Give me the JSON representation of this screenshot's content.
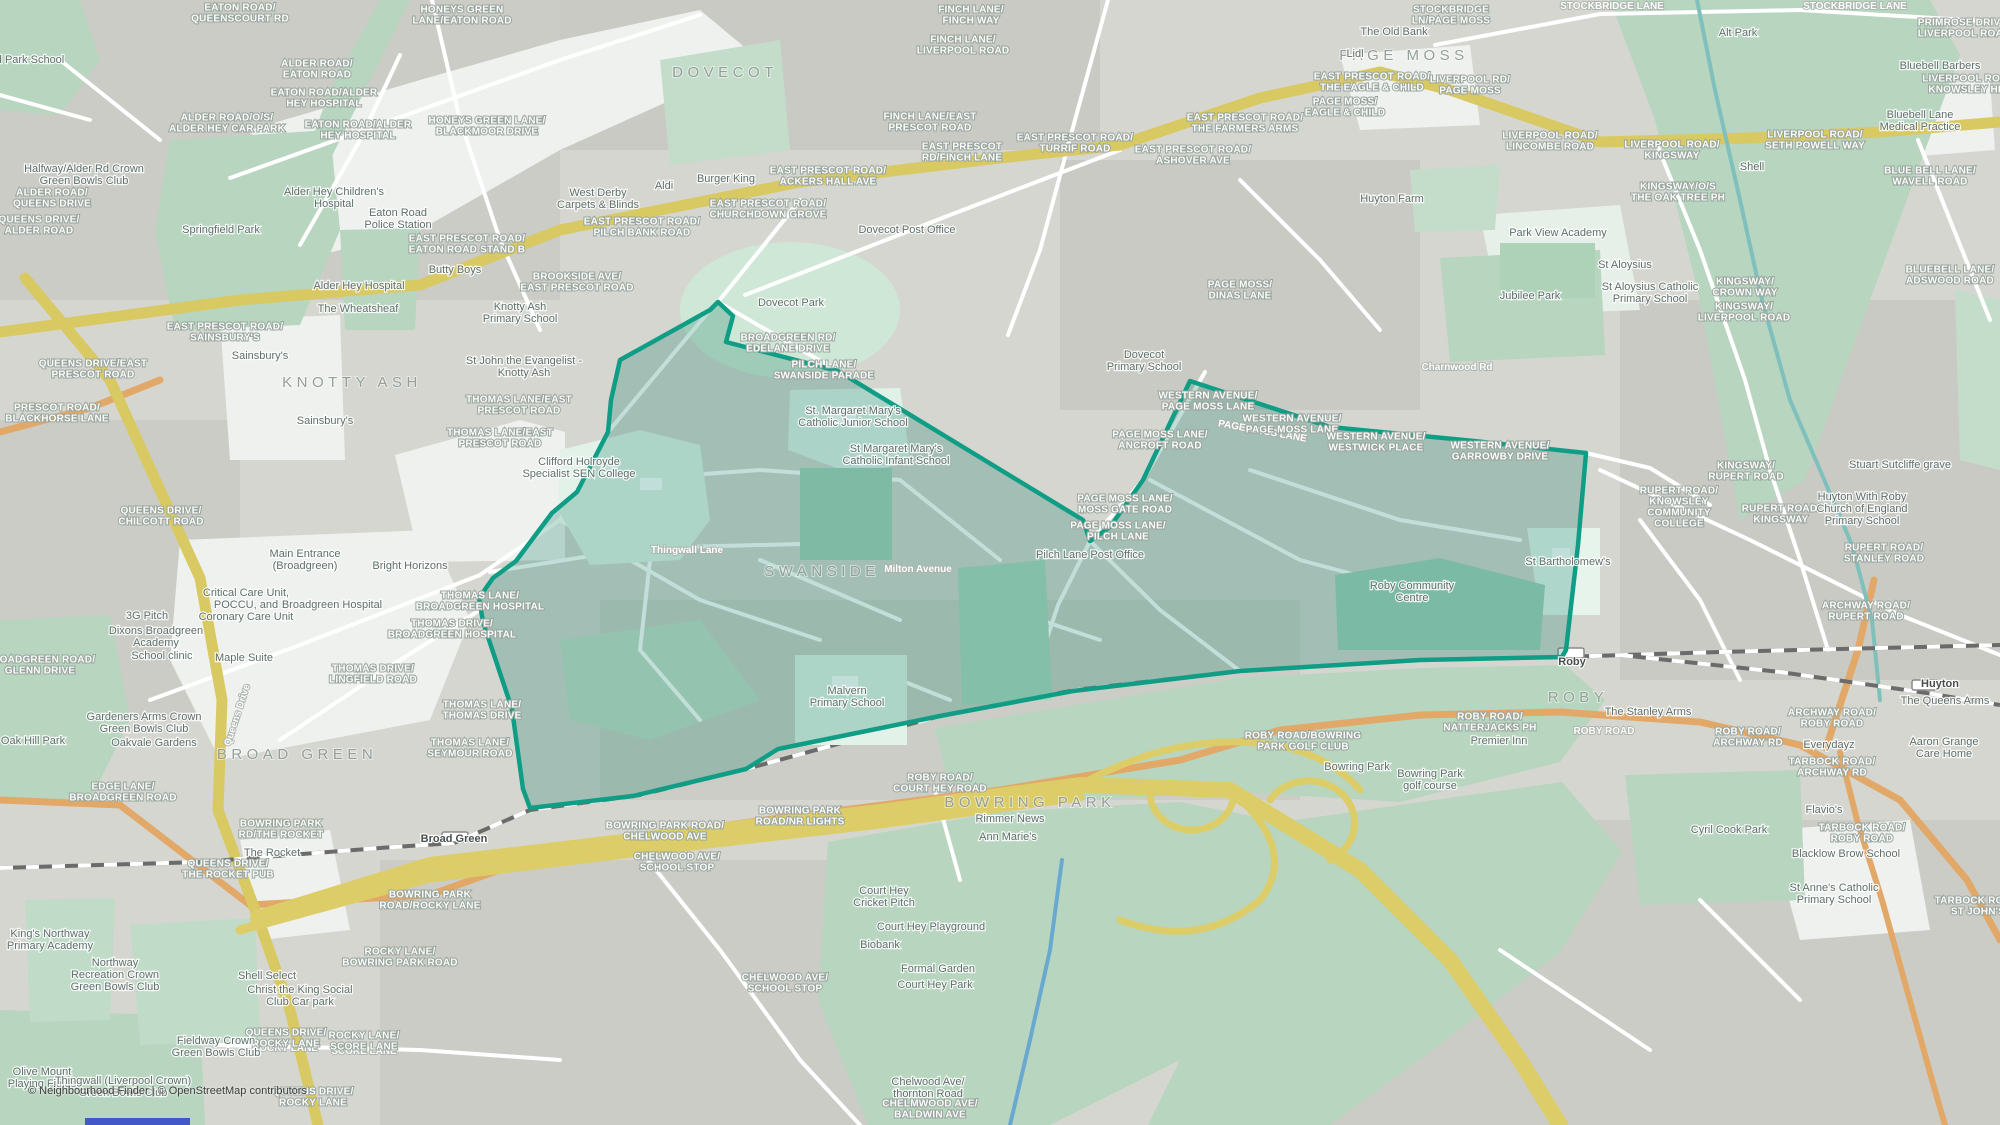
{
  "map": {
    "attribution": "© Neighbourhood Finder | © OpenStreetMap contributors",
    "colors": {
      "highlight_stroke": "#0f9e85",
      "highlight_fill": "rgba(18,128,106,0.26)",
      "motorway_yellow": "#ddcd68",
      "a_road_yellow": "#d9c963",
      "b_road_orange": "#e2a868",
      "park_green": "#b7d5bf",
      "mint": "#ddefe5",
      "water_teal": "#7fc0bd",
      "base_gray": "#d5d6d0"
    },
    "labels": {
      "districts": [
        {
          "label": "DOVECOT",
          "x": 725,
          "y": 77
        },
        {
          "label": "PAGE MOSS",
          "x": 1404,
          "y": 60
        },
        {
          "label": "KNOTTY ASH",
          "x": 352,
          "y": 387
        },
        {
          "label": "SWANSIDE",
          "x": 822,
          "y": 576
        },
        {
          "label": "BROAD GREEN",
          "x": 297,
          "y": 759
        },
        {
          "label": "BOWRING PARK",
          "x": 1030,
          "y": 807
        },
        {
          "label": "ROBY",
          "x": 1578,
          "y": 702
        }
      ],
      "stations": [
        {
          "label": "Broad Green",
          "x": 454,
          "y": 842
        },
        {
          "label": "Roby",
          "x": 1572,
          "y": 665
        },
        {
          "label": "Huyton",
          "x": 1940,
          "y": 687
        }
      ],
      "road_labels": [
        {
          "label": "Queens Drive",
          "x": 240,
          "y": 716,
          "rot": -72
        },
        {
          "label": "PAGE MOSS LANE",
          "x": 1262,
          "y": 434,
          "rot": 10
        },
        {
          "label": "ROBY ROAD",
          "x": 1604,
          "y": 734
        },
        {
          "label": "ROCKY LANE",
          "x": 285,
          "y": 1051
        },
        {
          "label": "SCORE LANE",
          "x": 364,
          "y": 1054
        },
        {
          "label": "STOCKBRIDGE LANE",
          "x": 1612,
          "y": 9
        },
        {
          "label": "STOCKBRIDGE LANE",
          "x": 1855,
          "y": 9
        },
        {
          "label": "Thingwall Lane",
          "x": 687,
          "y": 553
        },
        {
          "label": "Milton Avenue",
          "x": 918,
          "y": 572
        },
        {
          "label": "Charnwood Rd",
          "x": 1457,
          "y": 370
        }
      ],
      "bus_stops": [
        {
          "label": "EATON ROAD/\nQUEENSCOURT RD",
          "x": 240,
          "y": 16
        },
        {
          "label": "HONEYS GREEN\nLANE/EATON ROAD",
          "x": 462,
          "y": 18
        },
        {
          "label": "ALDER ROAD/\nEATON ROAD",
          "x": 317,
          "y": 72
        },
        {
          "label": "EATON ROAD/ALDER\nHEY HOSPITAL",
          "x": 324,
          "y": 101
        },
        {
          "label": "EATON ROAD/ALDER\nHEY HOSPITAL",
          "x": 358,
          "y": 133
        },
        {
          "label": "ALDER ROAD/O/S/\nALDER HEY CAR PARK",
          "x": 227,
          "y": 126
        },
        {
          "label": "HONEYS GREEN LANE/\nBLACKMOOR DRIVE",
          "x": 487,
          "y": 129
        },
        {
          "label": "ALDER ROAD/\nQUEENS DRIVE",
          "x": 52,
          "y": 201
        },
        {
          "label": "QUEENS DRIVE/\nALDER ROAD",
          "x": 39,
          "y": 228
        },
        {
          "label": "EAST PRESCOT ROAD/\nEATON ROAD STAND B",
          "x": 467,
          "y": 247
        },
        {
          "label": "EAST PRESCOT ROAD/\nSAINSBURY'S",
          "x": 225,
          "y": 335
        },
        {
          "label": "QUEENS DRIVE/EAST\nPRESCOT ROAD",
          "x": 93,
          "y": 372
        },
        {
          "label": "PRESCOT ROAD/\nBLACKHORSE LANE",
          "x": 57,
          "y": 416
        },
        {
          "label": "QUEENS DRIVE/\nCHILCOTT ROAD",
          "x": 161,
          "y": 519
        },
        {
          "label": "THOMAS LANE/EAST\nPRESCOT ROAD",
          "x": 519,
          "y": 408
        },
        {
          "label": "THOMAS LANE/EAST\nPRESCOT ROAD",
          "x": 500,
          "y": 441
        },
        {
          "label": "BROOKSIDE AVE/\nEAST PRESCOT ROAD",
          "x": 577,
          "y": 285
        },
        {
          "label": "EAST PRESCOT ROAD/\nPILCH BANK ROAD",
          "x": 642,
          "y": 230
        },
        {
          "label": "EAST PRESCOT ROAD/\nCHURCHDOWN GROVE",
          "x": 768,
          "y": 212
        },
        {
          "label": "EAST PRESCOT ROAD/\nACKERS HALL AVE",
          "x": 828,
          "y": 179
        },
        {
          "label": "FINCH LANE/EAST\nPRESCOT ROAD",
          "x": 930,
          "y": 125
        },
        {
          "label": "EAST PRESCOT\nRD/FINCH LANE",
          "x": 962,
          "y": 155
        },
        {
          "label": "FINCH LANE/\nFINCH WAY",
          "x": 971,
          "y": 18
        },
        {
          "label": "FINCH LANE/\nLIVERPOOL ROAD",
          "x": 963,
          "y": 48
        },
        {
          "label": "EAST PRESCOT ROAD/\nTURRIF ROAD",
          "x": 1075,
          "y": 146
        },
        {
          "label": "EAST PRESCOT ROAD/\nTHE EAGLE & CHILD",
          "x": 1372,
          "y": 85
        },
        {
          "label": "PAGE MOSS/\nEAGLE & CHILD",
          "x": 1345,
          "y": 110
        },
        {
          "label": "EAST PRESCOT ROAD/\nTHE FARMERS ARMS",
          "x": 1245,
          "y": 126
        },
        {
          "label": "EAST PRESCOT ROAD/\nASHOVER AVE",
          "x": 1193,
          "y": 158
        },
        {
          "label": "LIVERPOOL RD/\nPAGE MOSS",
          "x": 1470,
          "y": 88
        },
        {
          "label": "STOCKBRIDGE\nLN/PAGE MOSS",
          "x": 1451,
          "y": 18
        },
        {
          "label": "PAGE MOSS/\nDINAS LANE",
          "x": 1240,
          "y": 293
        },
        {
          "label": "LIVERPOOL ROAD/\nLINCOMBE ROAD",
          "x": 1550,
          "y": 144
        },
        {
          "label": "LIVERPOOL ROAD/\nKINGSWAY",
          "x": 1672,
          "y": 153
        },
        {
          "label": "KINGSWAY/O/S\nTHE OAK TREE PH",
          "x": 1678,
          "y": 195
        },
        {
          "label": "LIVERPOOL ROAD/\nSETH POWELL WAY",
          "x": 1815,
          "y": 143
        },
        {
          "label": "BLUE BELL LANE/\nWAVELL ROAD",
          "x": 1930,
          "y": 179
        },
        {
          "label": "PRIMROSE DRIVE/\nLIVERPOOL ROAD",
          "x": 1964,
          "y": 31
        },
        {
          "label": "LIVERPOOL ROAD/\nKNOWSLEY HEY",
          "x": 1970,
          "y": 87
        },
        {
          "label": "BLUEBELL LANE/\nADSWOOD ROAD",
          "x": 1950,
          "y": 278
        },
        {
          "label": "KINGSWAY/\nCROWN WAY",
          "x": 1745,
          "y": 290
        },
        {
          "label": "KINGSWAY/\nLIVERPOOL ROAD",
          "x": 1744,
          "y": 315
        },
        {
          "label": "WESTERN AVENUE/\nPAGE MOSS LANE",
          "x": 1208,
          "y": 404
        },
        {
          "label": "WESTERN AVENUE/\nPAGE MOSS LANE",
          "x": 1292,
          "y": 427
        },
        {
          "label": "WESTERN AVENUE/\nWESTWICK PLACE",
          "x": 1376,
          "y": 445
        },
        {
          "label": "WESTERN AVENUE/\nGARROWBY DRIVE",
          "x": 1500,
          "y": 454
        },
        {
          "label": "PAGE MOSS LANE/\nANCROFT ROAD",
          "x": 1160,
          "y": 443
        },
        {
          "label": "PAGE MOSS LANE/\nMOSS GATE ROAD",
          "x": 1125,
          "y": 507
        },
        {
          "label": "PAGE MOSS LANE/\nPILCH LANE",
          "x": 1118,
          "y": 534
        },
        {
          "label": "PILCH LANE/\nSWANSIDE PARADE",
          "x": 824,
          "y": 373
        },
        {
          "label": "BROADGREEN RD/\nEDELANE DRIVE",
          "x": 788,
          "y": 346
        },
        {
          "label": "KINGSWAY/\nRUPERT ROAD",
          "x": 1746,
          "y": 474
        },
        {
          "label": "RUPERT ROAD/\nKNOWSLEY\nCOMMUNITY\nCOLLEGE",
          "x": 1679,
          "y": 510
        },
        {
          "label": "RUPERT ROAD/\nKINGSWAY",
          "x": 1781,
          "y": 517
        },
        {
          "label": "RUPERT ROAD/\nSTANLEY ROAD",
          "x": 1884,
          "y": 556
        },
        {
          "label": "ARCHWAY ROAD/\nRUPERT ROAD",
          "x": 1866,
          "y": 614
        },
        {
          "label": "ROBY ROAD/\nNATTERJACKS PH",
          "x": 1490,
          "y": 725
        },
        {
          "label": "ROBY ROAD/BOWRING\nPARK GOLF CLUB",
          "x": 1303,
          "y": 744
        },
        {
          "label": "ROBY ROAD/\nCOURT HEY ROAD",
          "x": 940,
          "y": 786
        },
        {
          "label": "BOWRING PARK\nROAD/NR LIGHTS",
          "x": 800,
          "y": 819
        },
        {
          "label": "BOWRING PARK ROAD/\nCHELWOOD AVE",
          "x": 665,
          "y": 834
        },
        {
          "label": "CHELWOOD AVE/\nSCHOOL STOP",
          "x": 677,
          "y": 865
        },
        {
          "label": "CHELWOOD AVE/\nSCHOOL STOP",
          "x": 785,
          "y": 986
        },
        {
          "label": "CHELMWOOD AVE/\nBALDWIN AVE",
          "x": 930,
          "y": 1112
        },
        {
          "label": "THOMAS LANE/\nBROADGREEN HOSPITAL",
          "x": 480,
          "y": 604
        },
        {
          "label": "THOMAS DRIVE/\nBROADGREEN HOSPITAL",
          "x": 452,
          "y": 632
        },
        {
          "label": "THOMAS LANE/\nTHOMAS DRIVE",
          "x": 482,
          "y": 713
        },
        {
          "label": "THOMAS LANE/\nSEYMOUR ROAD",
          "x": 470,
          "y": 751
        },
        {
          "label": "THOMAS DRIVE/\nLINGFIELD ROAD",
          "x": 373,
          "y": 677
        },
        {
          "label": "BROADGREEN ROAD/\nGLENN DRIVE",
          "x": 40,
          "y": 668
        },
        {
          "label": "EDGE LANE/\nBROADGREEN ROAD",
          "x": 123,
          "y": 795
        },
        {
          "label": "BOWRING PARK\nRD/THE ROCKET",
          "x": 281,
          "y": 832
        },
        {
          "label": "QUEENS DRIVE/\nTHE ROCKET PUB",
          "x": 228,
          "y": 872
        },
        {
          "label": "BOWRING PARK\nROAD/ROCKY LANE",
          "x": 430,
          "y": 903
        },
        {
          "label": "ROCKY LANE/\nBOWRING PARK ROAD",
          "x": 400,
          "y": 960
        },
        {
          "label": "QUEENS DRIVE/\nROCKY LANE",
          "x": 286,
          "y": 1041
        },
        {
          "label": "QUEENS DRIVE/\nROCKY LANE",
          "x": 313,
          "y": 1100
        },
        {
          "label": "ROCKY LANE/\nSCORE LANE",
          "x": 364,
          "y": 1044
        },
        {
          "label": "ARCHWAY ROAD/\nROBY ROAD",
          "x": 1832,
          "y": 721
        },
        {
          "label": "ROBY ROAD/\nARCHWAY RD",
          "x": 1748,
          "y": 740
        },
        {
          "label": "TARBOCK ROAD/\nARCHWAY RD",
          "x": 1832,
          "y": 770
        },
        {
          "label": "TARBOCK ROAD/\nROBY ROAD",
          "x": 1862,
          "y": 836
        },
        {
          "label": "TARBOCK ROAD/\nST JOHN'S",
          "x": 1978,
          "y": 909
        }
      ],
      "pois": [
        {
          "label": "d Park School",
          "x": 30,
          "y": 63
        },
        {
          "label": "Halfway/Alder Rd Crown\nGreen Bowls Club",
          "x": 84,
          "y": 178
        },
        {
          "label": "Springfield Park",
          "x": 221,
          "y": 233
        },
        {
          "label": "Alder Hey Children's\nHospital",
          "x": 334,
          "y": 201
        },
        {
          "label": "Eaton Road\nPolice Station",
          "x": 398,
          "y": 222
        },
        {
          "label": "Butty Boys",
          "x": 455,
          "y": 273
        },
        {
          "label": "Alder Hey Hospital",
          "x": 359,
          "y": 289
        },
        {
          "label": "The Wheatsheaf",
          "x": 358,
          "y": 312
        },
        {
          "label": "Knotty Ash\nPrimary School",
          "x": 520,
          "y": 316
        },
        {
          "label": "St John the Evangelist -\nKnotty Ash",
          "x": 524,
          "y": 370
        },
        {
          "label": "Sainsbury's",
          "x": 260,
          "y": 359
        },
        {
          "label": "Sainsbury's",
          "x": 325,
          "y": 424
        },
        {
          "label": "Clifford Holroyde\nSpecialist SEN College",
          "x": 579,
          "y": 471
        },
        {
          "label": "Dovecot Park",
          "x": 791,
          "y": 306
        },
        {
          "label": "St. Margaret Mary's\nCatholic Junior School",
          "x": 853,
          "y": 420
        },
        {
          "label": "St Margaret Mary's\nCatholic Infant School",
          "x": 896,
          "y": 458
        },
        {
          "label": "West Derby\nCarpets & Blinds",
          "x": 598,
          "y": 202
        },
        {
          "label": "Aldi",
          "x": 664,
          "y": 189
        },
        {
          "label": "Burger King",
          "x": 726,
          "y": 182
        },
        {
          "label": "Dovecot Post Office",
          "x": 907,
          "y": 233
        },
        {
          "label": "Dovecot\nPrimary School",
          "x": 1144,
          "y": 364
        },
        {
          "label": "Pilch Lane Post Office",
          "x": 1090,
          "y": 558
        },
        {
          "label": "Malvern\nPrimary School",
          "x": 847,
          "y": 700
        },
        {
          "label": "Bright Horizons",
          "x": 410,
          "y": 569
        },
        {
          "label": "Main Entrance\n(Broadgreen)",
          "x": 305,
          "y": 563
        },
        {
          "label": "Critical Care Unit,\nPOCCU, and\nCoronary Care Unit",
          "x": 246,
          "y": 608
        },
        {
          "label": "Broadgreen Hospital",
          "x": 332,
          "y": 608
        },
        {
          "label": "3G Pitch",
          "x": 147,
          "y": 619
        },
        {
          "label": "Dixons Broadgreen\nAcademy",
          "x": 156,
          "y": 640
        },
        {
          "label": "School clinic",
          "x": 162,
          "y": 659
        },
        {
          "label": "Maple Suite",
          "x": 244,
          "y": 661
        },
        {
          "label": "Gardeners Arms Crown\nGreen Bowls Club",
          "x": 144,
          "y": 726
        },
        {
          "label": "Oakvale Gardens",
          "x": 154,
          "y": 746
        },
        {
          "label": "Oak Hill Park",
          "x": 33,
          "y": 744
        },
        {
          "label": "The Rocket",
          "x": 272,
          "y": 856
        },
        {
          "label": "King's Northway\nPrimary Academy",
          "x": 50,
          "y": 943
        },
        {
          "label": "Northway\nRecreation Crown\nGreen Bowls Club",
          "x": 115,
          "y": 978
        },
        {
          "label": "Shell Select",
          "x": 267,
          "y": 979
        },
        {
          "label": "Christ the King Social\nClub Car park",
          "x": 300,
          "y": 999
        },
        {
          "label": "Fieldway Crown\nGreen Bowls Club",
          "x": 216,
          "y": 1050
        },
        {
          "label": "Olive Mount\nPlaying Fields",
          "x": 42,
          "y": 1081
        },
        {
          "label": "Thingwall (Liverpool Crown)\nGreen Bowls Club",
          "x": 123,
          "y": 1090
        },
        {
          "label": "The Old Bank",
          "x": 1394,
          "y": 35
        },
        {
          "label": "Lidl",
          "x": 1355,
          "y": 57
        },
        {
          "label": "Huyton Farm",
          "x": 1392,
          "y": 202
        },
        {
          "label": "Park View Academy",
          "x": 1558,
          "y": 236
        },
        {
          "label": "St Aloysius",
          "x": 1625,
          "y": 268
        },
        {
          "label": "St Aloysius Catholic\nPrimary School",
          "x": 1650,
          "y": 296
        },
        {
          "label": "Jubilee Park",
          "x": 1530,
          "y": 299
        },
        {
          "label": "Shell",
          "x": 1752,
          "y": 170
        },
        {
          "label": "Bluebell Lane\nMedical Practice",
          "x": 1920,
          "y": 124
        },
        {
          "label": "Bluebell Barbers",
          "x": 1940,
          "y": 69
        },
        {
          "label": "Alt Park",
          "x": 1738,
          "y": 36
        },
        {
          "label": "Stuart Sutcliffe grave",
          "x": 1900,
          "y": 468
        },
        {
          "label": "Huyton With Roby\nChurch of England\nPrimary School",
          "x": 1862,
          "y": 512
        },
        {
          "label": "St Bartholomew's",
          "x": 1568,
          "y": 565
        },
        {
          "label": "Roby Community\nCentre",
          "x": 1412,
          "y": 595
        },
        {
          "label": "The Stanley Arms",
          "x": 1648,
          "y": 715
        },
        {
          "label": "Premier Inn",
          "x": 1499,
          "y": 744
        },
        {
          "label": "Rimmer News",
          "x": 1010,
          "y": 822
        },
        {
          "label": "Ann Marie's",
          "x": 1008,
          "y": 840
        },
        {
          "label": "Court Hey\nCricket Pitch",
          "x": 884,
          "y": 900
        },
        {
          "label": "Court Hey Playground",
          "x": 931,
          "y": 930
        },
        {
          "label": "Biobank",
          "x": 880,
          "y": 948
        },
        {
          "label": "Formal Garden",
          "x": 938,
          "y": 972
        },
        {
          "label": "Court Hey Park",
          "x": 935,
          "y": 988
        },
        {
          "label": "Bowring Park",
          "x": 1357,
          "y": 770
        },
        {
          "label": "Bowring Park\ngolf course",
          "x": 1430,
          "y": 783
        },
        {
          "label": "Cyril Cook Park",
          "x": 1729,
          "y": 833
        },
        {
          "label": "Everydayz",
          "x": 1829,
          "y": 748
        },
        {
          "label": "Flavio's",
          "x": 1824,
          "y": 813
        },
        {
          "label": "Blacklow Brow School",
          "x": 1846,
          "y": 857
        },
        {
          "label": "St Anne's Catholic\nPrimary School",
          "x": 1834,
          "y": 897
        },
        {
          "label": "Aaron Grange\nCare Home",
          "x": 1944,
          "y": 751
        },
        {
          "label": "The Queens Arms",
          "x": 1945,
          "y": 704
        },
        {
          "label": "Chelwood Ave/\nthornton Road",
          "x": 928,
          "y": 1091
        }
      ]
    }
  }
}
